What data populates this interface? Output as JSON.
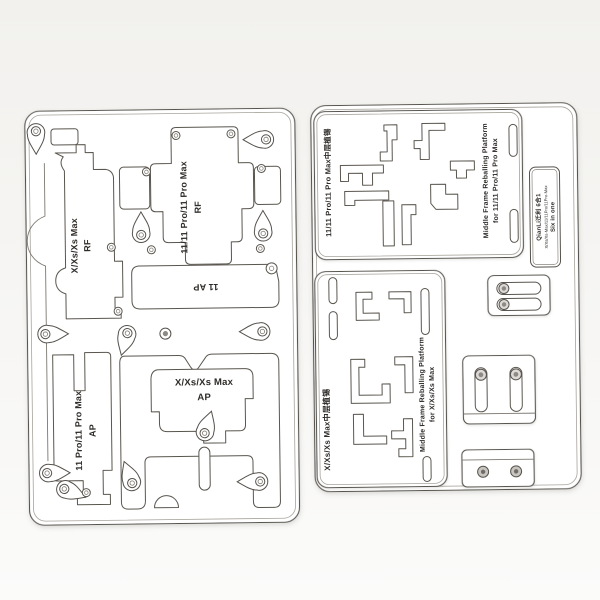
{
  "scene": {
    "description": "Product photo: QianLi six-in-one iPhone middle frame reballing platform with engraved stencil plates and clamp accessories"
  },
  "colors": {
    "background_top": "#f3f2ef",
    "background_bottom": "#fbfbfa",
    "plate": "#ffffff",
    "line": "#56524d",
    "text": "#2e2b28",
    "metal": "#c8c5c1"
  },
  "main_platform": {
    "rf_x": {
      "line1": "X/Xs/Xs Max",
      "line2": "RF"
    },
    "rf_11": {
      "line1": "11/11 Pro/11 Pro Max",
      "line2": "RF"
    },
    "ap_11": "11 AP",
    "ap_11pro": {
      "line1": "11 Pro/11 Pro Max",
      "line2": "AP"
    },
    "ap_x": {
      "line1": "X/Xs/Xs Max",
      "line2": "AP"
    }
  },
  "stencil_11": {
    "label_cn": "11/11 Pro/11 Pro Max中层植锡",
    "label_en1": "Middle Frame Reballing Platform",
    "label_en2": "for 11/11 Pro/11 Pro Max"
  },
  "stencil_x": {
    "label_cn": "X/Xs/Xs Max中层植锡",
    "label_en1": "Middle Frame Reballing Platform",
    "label_en2": "for X/Xs/Xs Max"
  },
  "brand_label": {
    "line1": "QianLi迁利 6合1",
    "line2": "X/Xs/Xs-Max/11/11Pro/11Pro-Max",
    "line3": "Six in one"
  }
}
